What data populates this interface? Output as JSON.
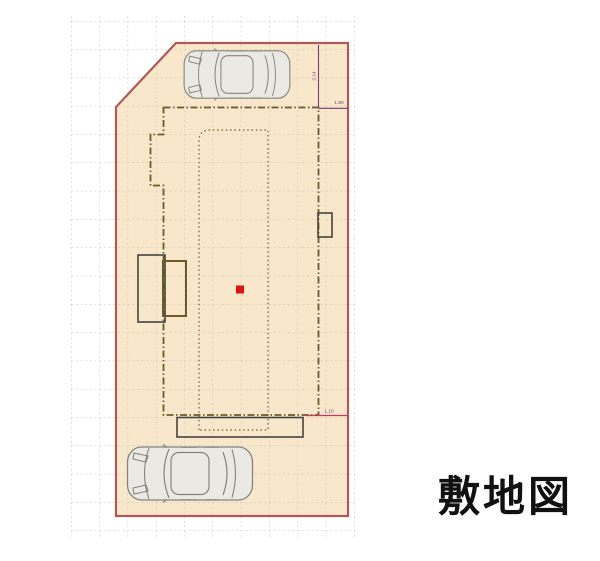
{
  "title": "敷地図",
  "dimensions": {
    "top_vertical": "2.14",
    "top_horizontal": "1.80",
    "bottom_horizontal": "1.10"
  },
  "colors": {
    "site-fill": "#f9e7cb",
    "site-boundary": "#ae5a57",
    "building-line": "#6b5b26",
    "detail-line": "#44443e",
    "grid-line": "#c4c0b8",
    "dimension-line": "#7a3a72",
    "dimension-line-alt": "#c23a62",
    "marker-red": "#e01212",
    "car-fill": "#ebe9e4",
    "car-line": "#84847e",
    "title-color": "#111111"
  }
}
